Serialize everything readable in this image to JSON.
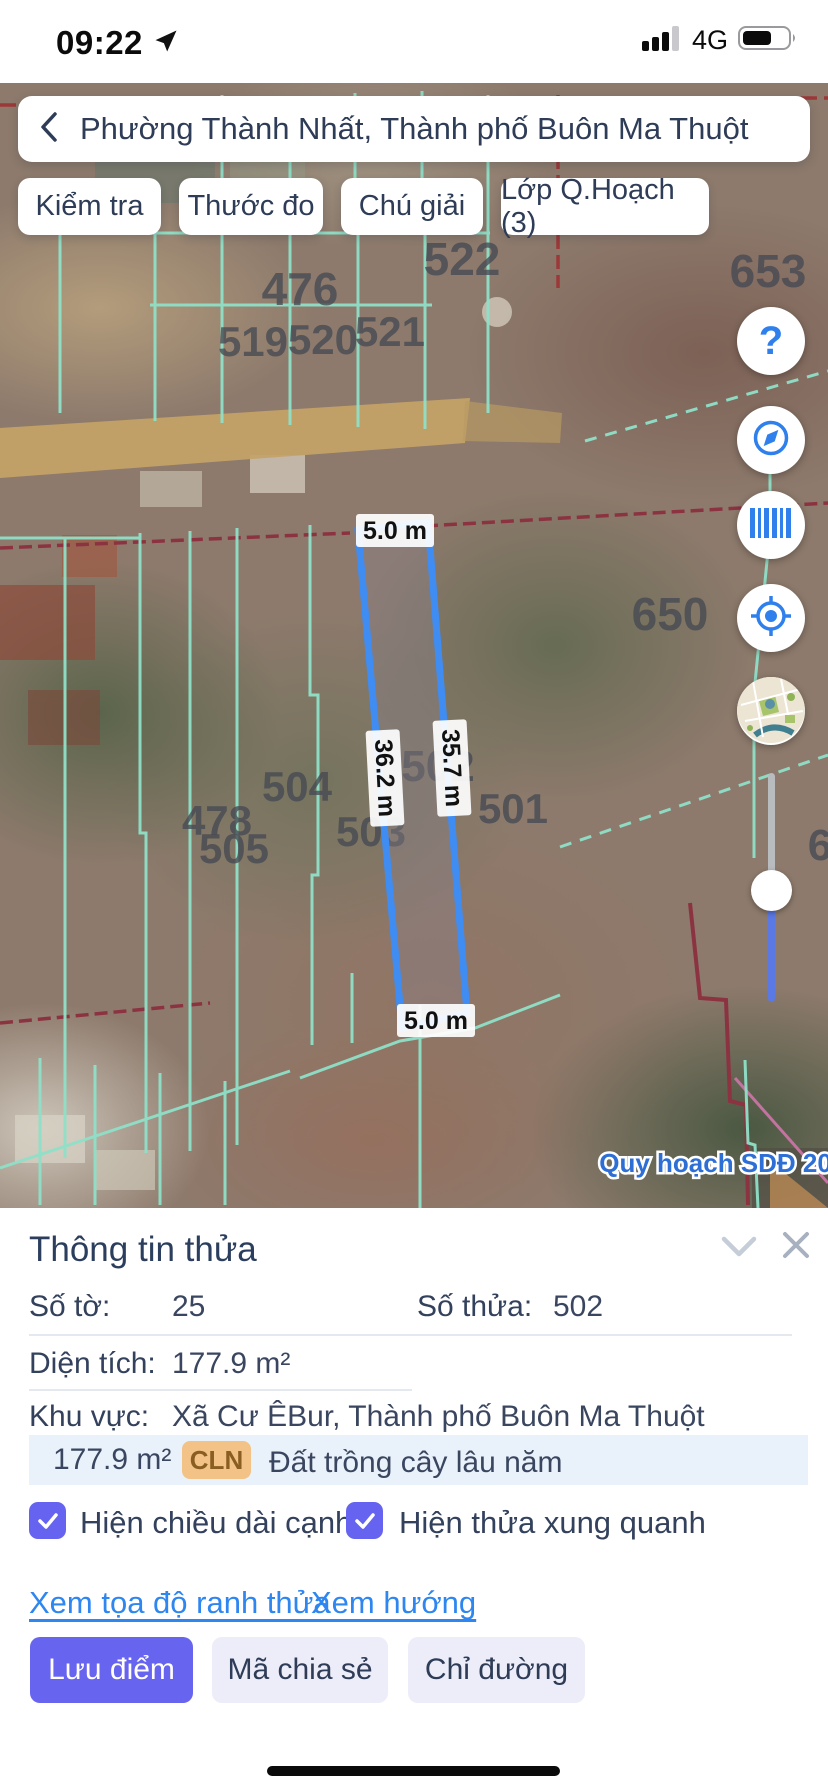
{
  "status_bar": {
    "time": "09:22",
    "network": "4G"
  },
  "header": {
    "title": "Phường Thành Nhất, Thành phố Buôn Ma Thuột"
  },
  "toolbar": {
    "buttons": [
      "Kiểm tra",
      "Thước đo",
      "Chú giải",
      "Lớp Q.Hoạch (3)"
    ]
  },
  "map": {
    "parcel_labels": [
      "476",
      "522",
      "653",
      "519",
      "520",
      "521",
      "650",
      "502",
      "504",
      "503",
      "478",
      "505",
      "501",
      "6"
    ],
    "selected": {
      "top": "5.0 m",
      "bottom": "5.0 m",
      "left_side": "36.2 m",
      "right_side": "35.7 m"
    },
    "overlay_badge": "Quy hoạch SDĐ 2030"
  },
  "panel": {
    "title": "Thông tin thửa",
    "so_to_label": "Số tờ:",
    "so_to_value": "25",
    "so_thua_label": "Số thửa:",
    "so_thua_value": "502",
    "dien_tich_label": "Diện tích:",
    "dien_tich_value": "177.9 m²",
    "khu_vuc_label": "Khu vực:",
    "khu_vuc_value": "Xã Cư ÊBur, Thành phố Buôn Ma Thuột",
    "land_area": "177.9 m²",
    "land_code": "CLN",
    "land_name": "Đất trồng cây lâu năm",
    "checkbox1": "Hiện chiều dài cạnh",
    "checkbox2": "Hiện thửa xung quanh",
    "link1": "Xem tọa độ ranh thửa",
    "link2": "Xem hướng",
    "btn_save": "Lưu điểm",
    "btn_share": "Mã chia sẻ",
    "btn_directions": "Chỉ đường"
  },
  "colors": {
    "accent_blue": "#2f80ed",
    "parcel_stroke": "#3f8cf3",
    "teal_line": "#8fe0c8",
    "red_line": "#9c3838",
    "purple": "#6764ef",
    "cln_bg": "#f3c286",
    "link_blue": "#2e86f0"
  }
}
